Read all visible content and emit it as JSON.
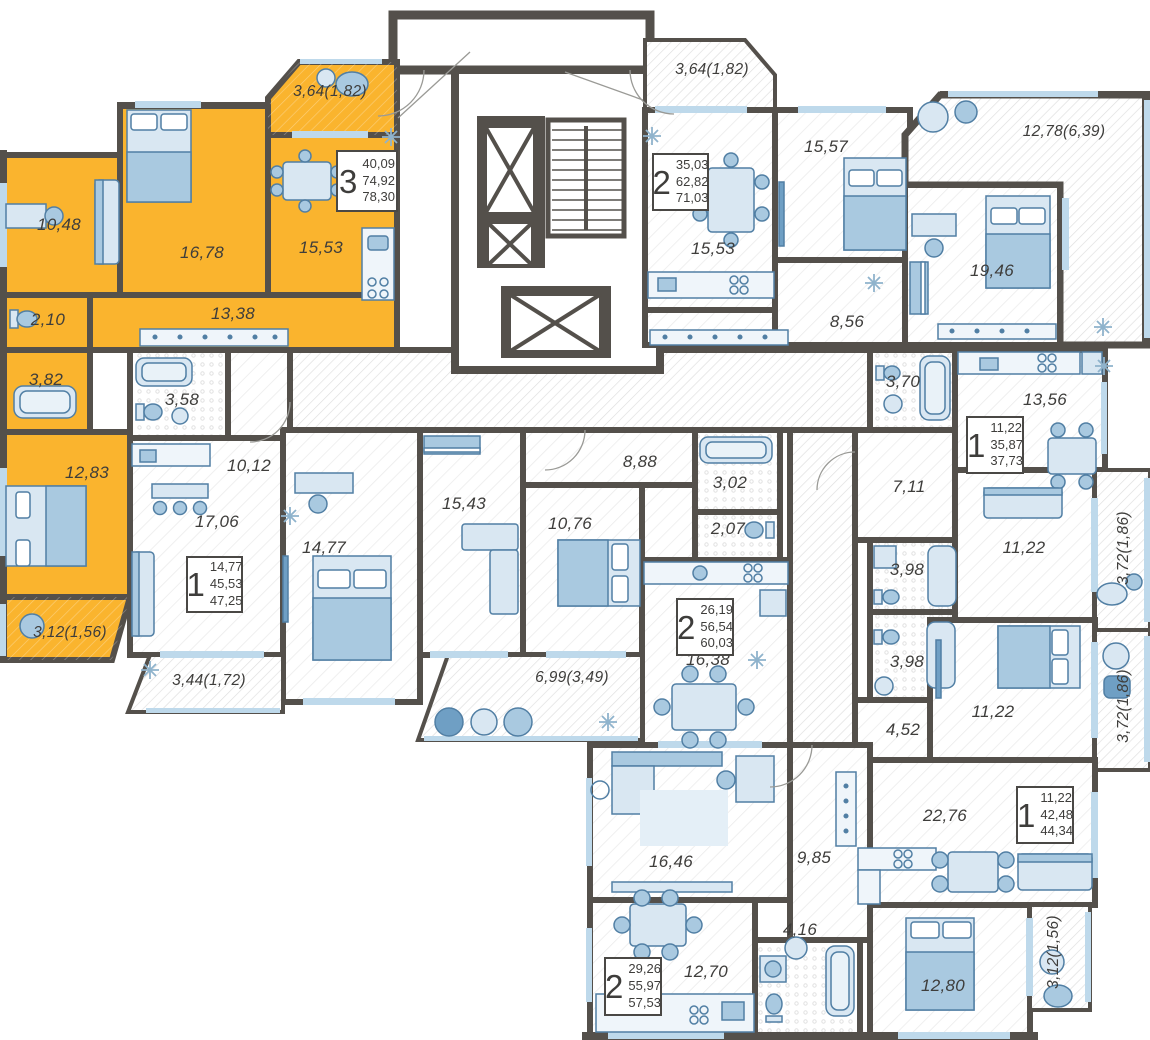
{
  "colors": {
    "highlight_yellow": "#FAB42E",
    "wall": "#54504B",
    "furniture_light": "#D9E7F2",
    "furniture_mid": "#A9C9E0",
    "furniture_dark": "#6F9FC4",
    "window_blue": "#BED9EB",
    "label_text": "#3E3D3B"
  },
  "plates": [
    {
      "num": "3",
      "a1": "40,09",
      "a2": "74,92",
      "a3": "78,30"
    },
    {
      "num": "1",
      "a1": "14,77",
      "a2": "45,53",
      "a3": "47,25"
    },
    {
      "num": "2",
      "a1": "26,19",
      "a2": "56,54",
      "a3": "60,03"
    },
    {
      "num": "2",
      "a1": "35,03",
      "a2": "62,82",
      "a3": "71,03"
    },
    {
      "num": "1",
      "a1": "11,22",
      "a2": "35,87",
      "a3": "37,73"
    },
    {
      "num": "1",
      "a1": "11,22",
      "a2": "42,48",
      "a3": "44,34"
    },
    {
      "num": "2",
      "a1": "29,26",
      "a2": "55,97",
      "a3": "57,53"
    }
  ],
  "room_labels": [
    {
      "text": "10,48"
    },
    {
      "text": "16,78"
    },
    {
      "text": "15,53"
    },
    {
      "text": "13,38"
    },
    {
      "text": "2,10"
    },
    {
      "text": "3,82"
    },
    {
      "text": "12,83"
    },
    {
      "text": "3,64(1,82)"
    },
    {
      "text": "3,12(1,56)"
    },
    {
      "text": "3,58"
    },
    {
      "text": "10,12"
    },
    {
      "text": "17,06"
    },
    {
      "text": "3,44(1,72)"
    },
    {
      "text": "14,77"
    },
    {
      "text": "15,43"
    },
    {
      "text": "10,76"
    },
    {
      "text": "8,88"
    },
    {
      "text": "3,02"
    },
    {
      "text": "2,07"
    },
    {
      "text": "16,38"
    },
    {
      "text": "6,99(3,49)"
    },
    {
      "text": "3,64(1,82)"
    },
    {
      "text": "15,53"
    },
    {
      "text": "15,57"
    },
    {
      "text": "8,56"
    },
    {
      "text": "19,46"
    },
    {
      "text": "12,78(6,39)"
    },
    {
      "text": "3,70"
    },
    {
      "text": "13,56"
    },
    {
      "text": "7,11"
    },
    {
      "text": "11,22"
    },
    {
      "text": "3,72(1,86)"
    },
    {
      "text": "3,98"
    },
    {
      "text": "3,98"
    },
    {
      "text": "11,22"
    },
    {
      "text": "4,52"
    },
    {
      "text": "3,72(1,86)"
    },
    {
      "text": "22,76"
    },
    {
      "text": "16,46"
    },
    {
      "text": "9,85"
    },
    {
      "text": "12,70"
    },
    {
      "text": "4,16"
    },
    {
      "text": "12,80"
    },
    {
      "text": "3,12(1,56)"
    }
  ]
}
